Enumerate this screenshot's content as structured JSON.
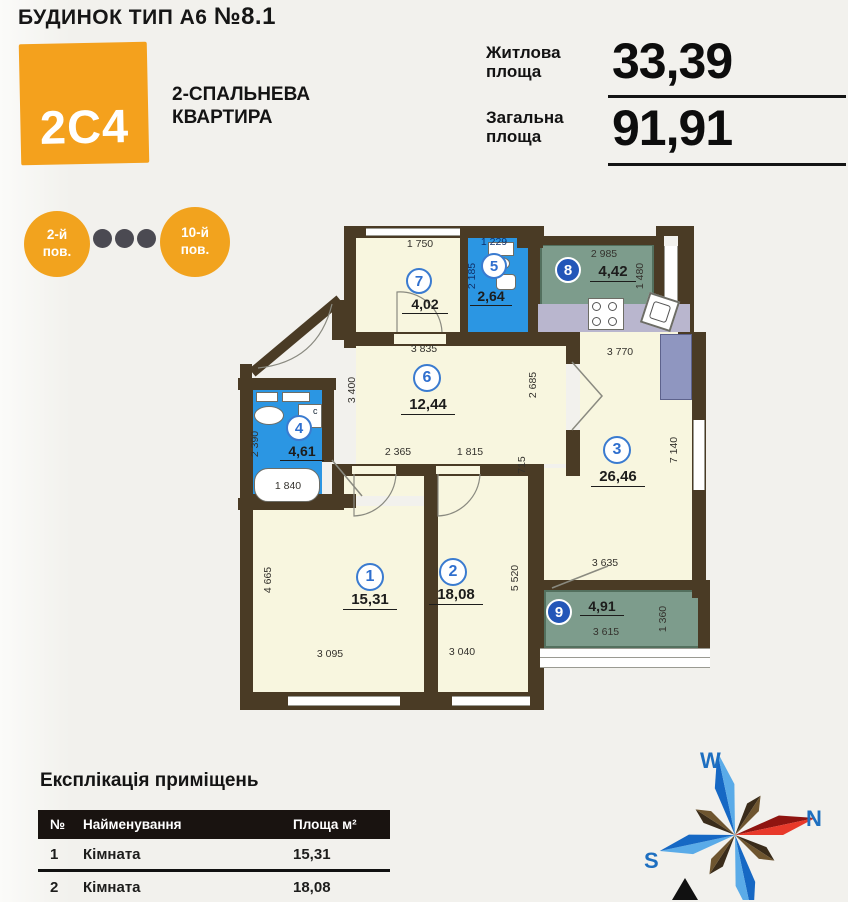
{
  "header": {
    "building_title_prefix": "БУДИНОК ТИП А6 ",
    "building_no": "№8.1",
    "unit_code": "2С4",
    "unit_type_line1": "2-СПАЛЬНЕВА",
    "unit_type_line2": "КВАРТИРА",
    "stats": [
      {
        "label1": "Житлова",
        "label2": "площа",
        "value": "33,39"
      },
      {
        "label1": "Загальна",
        "label2": "площа",
        "value": "91,91"
      }
    ]
  },
  "floors": {
    "start1": "2-й",
    "start2": "пов.",
    "end1": "10-й",
    "end2": "пов."
  },
  "colors": {
    "accent_orange": "#f4a11d",
    "wall_brown": "#4a3b25",
    "room_cream": "#f8f6df",
    "wet_blue": "#2b96e3",
    "loggia_green": "#7d9c8c",
    "counter_gray": "#b9b6ce"
  },
  "plan": {
    "rooms": [
      {
        "num": "1",
        "area": "15,31"
      },
      {
        "num": "2",
        "area": "18,08"
      },
      {
        "num": "3",
        "area": "26,46"
      },
      {
        "num": "4",
        "area": "4,61"
      },
      {
        "num": "5",
        "area": "2,64"
      },
      {
        "num": "6",
        "area": "12,44"
      },
      {
        "num": "7",
        "area": "4,02"
      },
      {
        "num": "8",
        "area": "4,42"
      },
      {
        "num": "9",
        "area": "4,91"
      }
    ],
    "dims": {
      "r7_top": "1 750",
      "r5_top": "1 229",
      "r5_left": "2 185",
      "r8_top": "2 985",
      "r8_right": "1 480",
      "r6_top": "3 835",
      "r3_top": "3 770",
      "r6_left": "3 400",
      "r6_right": "2 685",
      "r6_bottom_left": "2 365",
      "r6_bottom_right": "1 815",
      "r6_small": "715",
      "r4_left": "2 390",
      "r4_tub": "1 840",
      "r4_washer": "с",
      "r3_right": "7 140",
      "r1_left": "4 665",
      "r1_bottom": "3 095",
      "r2_bottom": "3 040",
      "r2_right": "5 520",
      "r9_top": "3 635",
      "r9_bottom": "3 615",
      "r9_right": "1 360"
    }
  },
  "explication": {
    "title": "Експлікація приміщень",
    "columns": {
      "no": "№",
      "name": "Найменування",
      "area": "Площа м²"
    },
    "rows": [
      {
        "no": "1",
        "name": "Кімната",
        "area": "15,31"
      },
      {
        "no": "2",
        "name": "Кімната",
        "area": "18,08"
      }
    ]
  },
  "compass": {
    "w": "W",
    "n": "N",
    "s": "S"
  }
}
